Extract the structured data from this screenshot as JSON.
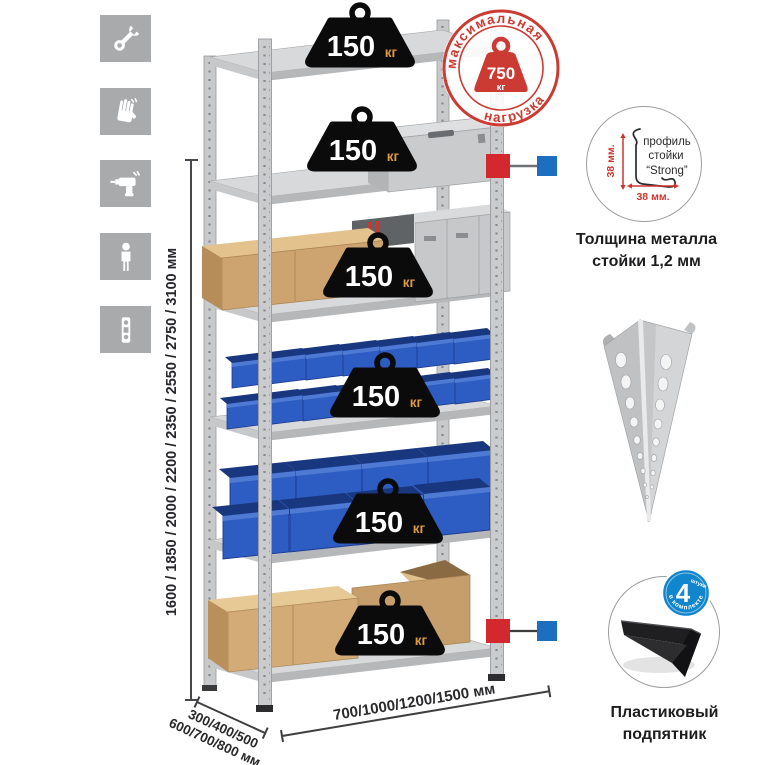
{
  "icons": [
    {
      "name": "wrench-icon"
    },
    {
      "name": "gloves-icon"
    },
    {
      "name": "drill-icon"
    },
    {
      "name": "person-height-icon"
    },
    {
      "name": "level-icon"
    }
  ],
  "dimensions": {
    "height": "1600 / 1850 / 2000 / 2200 / 2350 / 2550 / 2750 / 3100 мм",
    "depth_line1": "300/400/500",
    "depth_line2": "600/700/800 мм",
    "width": "700/1000/1200/1500 мм"
  },
  "load_stamp": {
    "arc_top": "максимальная",
    "arc_bottom": "нагрузка",
    "value": "750",
    "unit": "кг"
  },
  "shelves": [
    {
      "load": "150",
      "unit": "кг"
    },
    {
      "load": "150",
      "unit": "кг"
    },
    {
      "load": "150",
      "unit": "кг"
    },
    {
      "load": "150",
      "unit": "кг"
    },
    {
      "load": "150",
      "unit": "кг"
    },
    {
      "load": "150",
      "unit": "кг"
    }
  ],
  "profile_detail": {
    "label_line1": "профиль",
    "label_line2": "стойки",
    "label_line3": "“Strong”",
    "dim_vertical": "38 мм.",
    "dim_horizontal": "38 мм.",
    "caption_line1": "Толщина металла",
    "caption_line2": "стойки 1,2 мм"
  },
  "foot_detail": {
    "badge_value": "4",
    "badge_small": "штуки",
    "badge_arc": "в комплекте",
    "caption_line1": "Пластиковый",
    "caption_line2": "подпятник"
  },
  "colors": {
    "accent_red": "#cc3b33",
    "accent_blue": "#1b6fbe",
    "metal_gray": "#c7c9cb",
    "bin_blue": "#2d5cc2",
    "cardboard": "#cfa473",
    "icon_gray": "#a8aaac",
    "weight_black": "#0b0b0c"
  }
}
